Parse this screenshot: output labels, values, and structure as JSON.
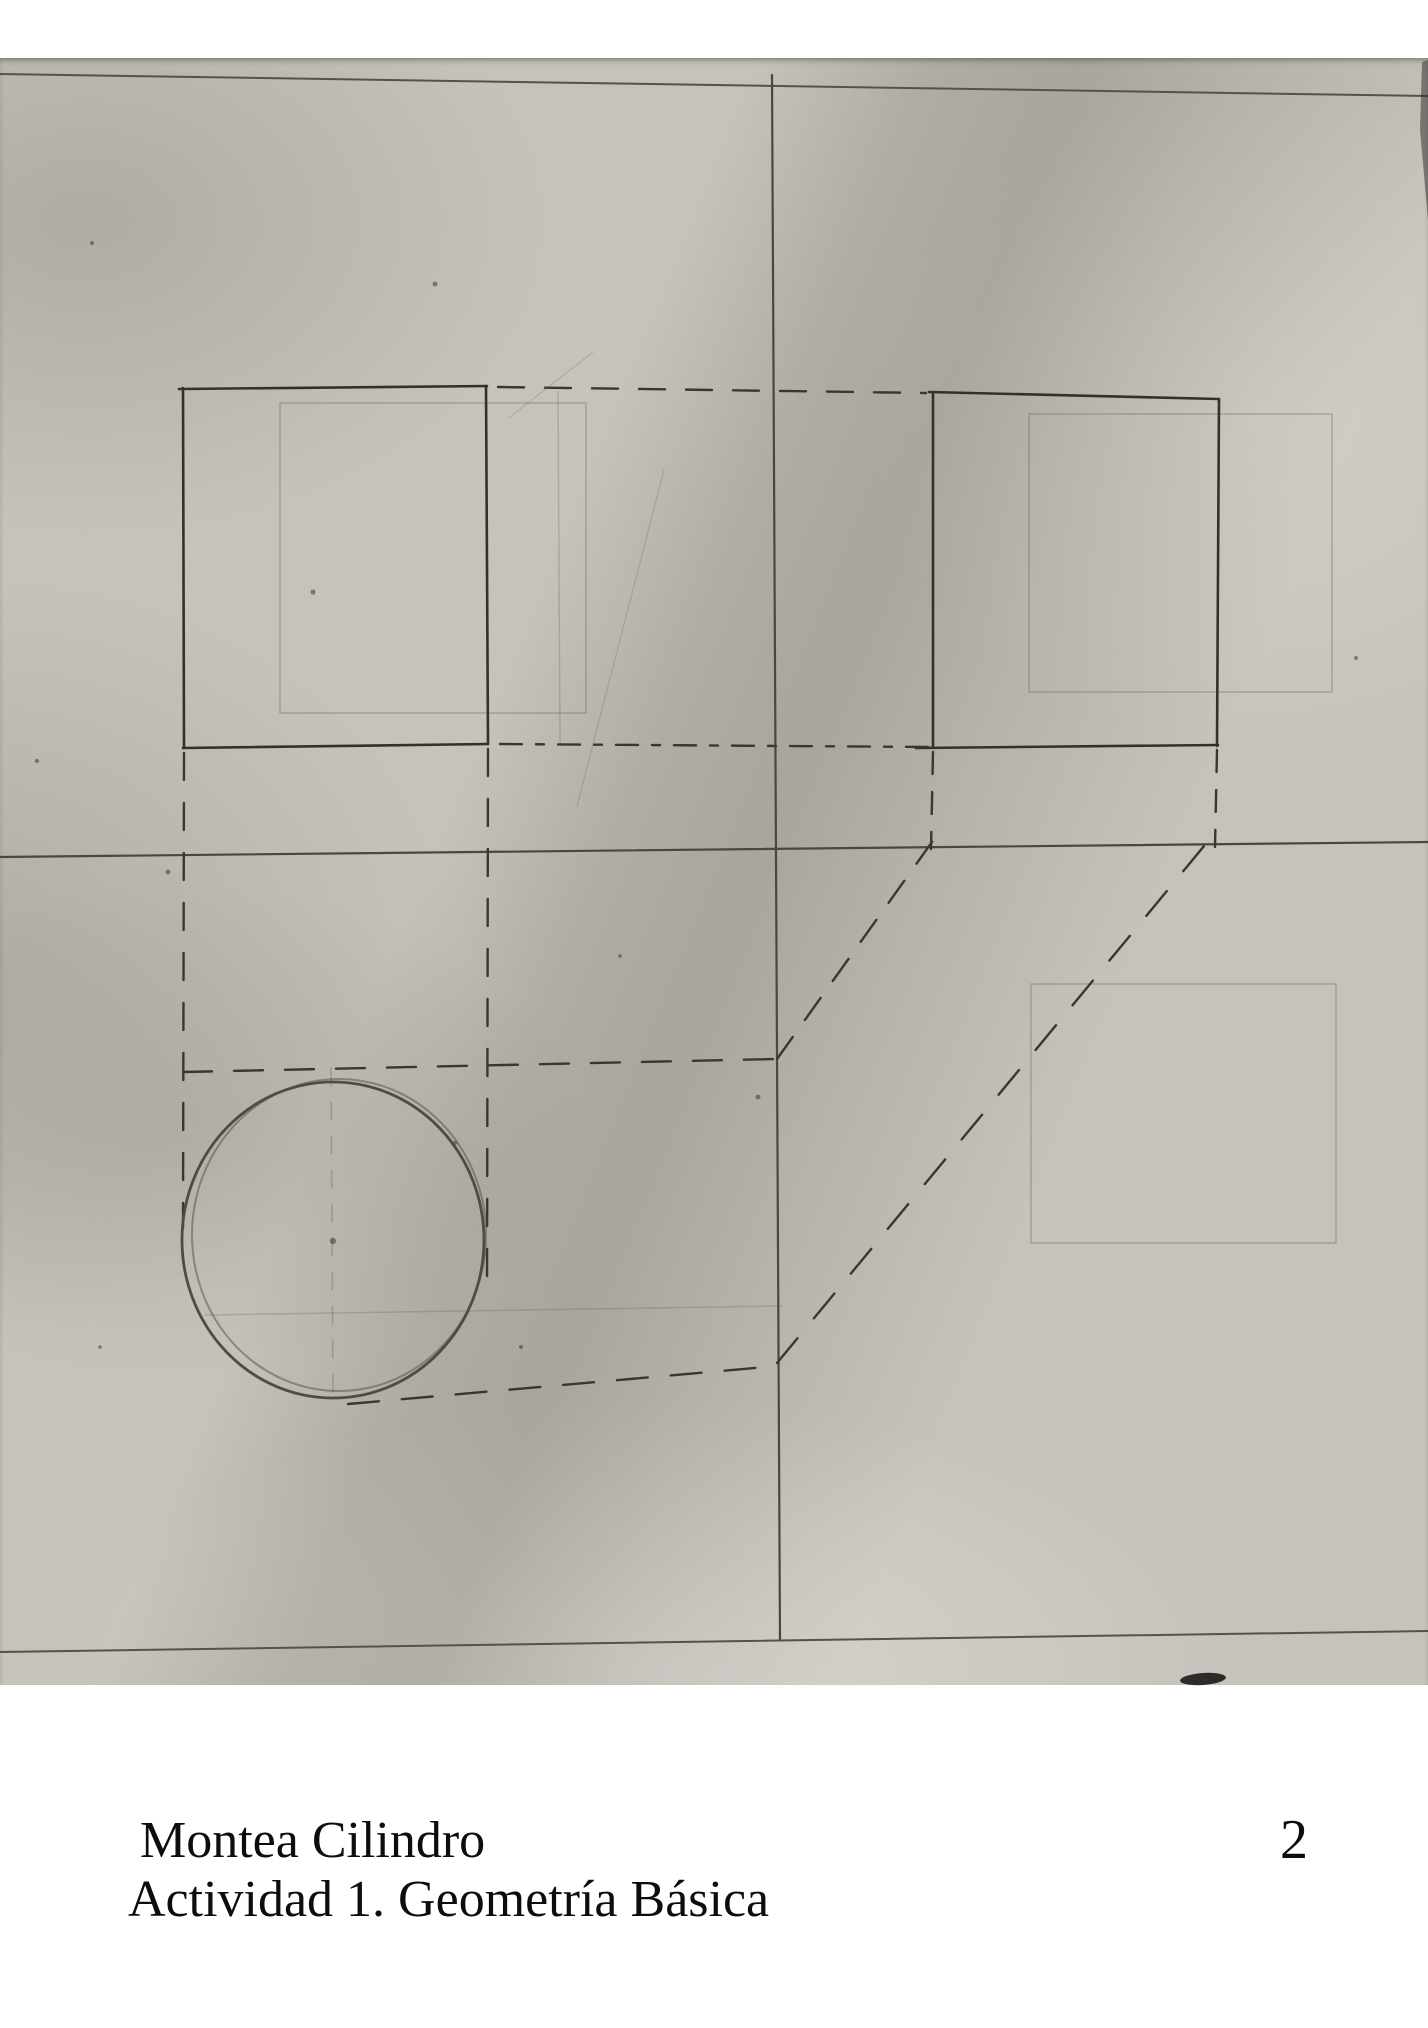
{
  "document": {
    "caption": {
      "line1": "Montea Cilindro",
      "line2": "Actividad 1. Geometría Básica"
    },
    "page_number": "2"
  },
  "drawing": {
    "colors": {
      "pencil": "#34312c",
      "frame": "#55524d",
      "dash": "#3a3732",
      "faint": "rgba(96,91,83,0.32)",
      "circle": "#4f4c46",
      "dot": "rgba(60,56,50,0.55)",
      "smudge": "#2e2c29"
    },
    "lines": [
      {
        "name": "sheet-top-border",
        "x1": 0,
        "y1": 74,
        "x2": 1428,
        "y2": 96,
        "w": 2,
        "color": "#55524d"
      },
      {
        "name": "sheet-bottom-border",
        "x1": 0,
        "y1": 1652,
        "x2": 1428,
        "y2": 1631,
        "w": 2,
        "color": "#55524d"
      },
      {
        "name": "vertical-divider",
        "x1": 772,
        "y1": 75,
        "x2": 780,
        "y2": 1640,
        "w": 2.2,
        "color": "#4a4741"
      },
      {
        "name": "horizontal-divider",
        "x1": 0,
        "y1": 857,
        "x2": 1428,
        "y2": 842,
        "w": 2.2,
        "color": "#4a4741"
      },
      {
        "name": "front-view-left-edge",
        "x1": 183,
        "y1": 388,
        "x2": 184,
        "y2": 748,
        "w": 2.6
      },
      {
        "name": "front-view-top-edge",
        "x1": 179,
        "y1": 389,
        "x2": 487,
        "y2": 386,
        "w": 2.6
      },
      {
        "name": "front-view-right-edge",
        "x1": 486,
        "y1": 386,
        "x2": 488,
        "y2": 744,
        "w": 2.6
      },
      {
        "name": "front-view-bottom-edge",
        "x1": 183,
        "y1": 748,
        "x2": 488,
        "y2": 744,
        "w": 2.6
      },
      {
        "name": "side-view-left-edge",
        "x1": 933,
        "y1": 394,
        "x2": 933,
        "y2": 747,
        "w": 2.6
      },
      {
        "name": "side-view-top-edge",
        "x1": 929,
        "y1": 392,
        "x2": 1219,
        "y2": 399,
        "w": 2.6
      },
      {
        "name": "side-view-right-edge",
        "x1": 1219,
        "y1": 399,
        "x2": 1217,
        "y2": 746,
        "w": 2.6
      },
      {
        "name": "side-view-bottom-edge",
        "x1": 916,
        "y1": 748,
        "x2": 1218,
        "y2": 745,
        "w": 2.6
      },
      {
        "name": "projection-top-connector",
        "x1": 498,
        "y1": 387,
        "x2": 926,
        "y2": 393,
        "w": 2.4,
        "color": "#3a3732",
        "dash": "26 21"
      },
      {
        "name": "projection-bottom-connector",
        "x1": 500,
        "y1": 744,
        "x2": 928,
        "y2": 747,
        "w": 2.4,
        "color": "#3a3732",
        "dash": "22 14 8 14"
      },
      {
        "name": "projection-below-front-left",
        "x1": 184,
        "y1": 753,
        "x2": 183,
        "y2": 1228,
        "w": 2.4,
        "color": "#3a3732",
        "dash": "27 23"
      },
      {
        "name": "projection-below-front-right",
        "x1": 488,
        "y1": 749,
        "x2": 487,
        "y2": 1292,
        "w": 2.4,
        "color": "#3a3732",
        "dash": "27 23"
      },
      {
        "name": "projection-below-side-left",
        "x1": 933,
        "y1": 752,
        "x2": 931,
        "y2": 849,
        "w": 2.4,
        "color": "#3a3732",
        "dash": "22 18"
      },
      {
        "name": "projection-below-side-right",
        "x1": 1217,
        "y1": 750,
        "x2": 1215,
        "y2": 847,
        "w": 2.4,
        "color": "#3a3732",
        "dash": "22 18"
      },
      {
        "name": "topview-front-edge",
        "x1": 183,
        "y1": 1072,
        "x2": 777,
        "y2": 1059,
        "w": 2.4,
        "color": "#3a3732",
        "dash": "29 22"
      },
      {
        "name": "topview-back-edge",
        "x1": 348,
        "y1": 1404,
        "x2": 777,
        "y2": 1366,
        "w": 2.4,
        "color": "#3a3732",
        "dash": "31 23"
      },
      {
        "name": "transfer-diagonal-short",
        "x1": 777,
        "y1": 1059,
        "x2": 937,
        "y2": 835,
        "w": 2.4,
        "color": "#3a3732",
        "dash": "27 21"
      },
      {
        "name": "transfer-diagonal-long",
        "x1": 777,
        "y1": 1363,
        "x2": 1209,
        "y2": 840,
        "w": 2.4,
        "color": "#3a3732",
        "dash": "32 26"
      },
      {
        "name": "circle-vertical-centerline",
        "x1": 331,
        "y1": 1068,
        "x2": 333,
        "y2": 1398,
        "w": 1.6,
        "color": "rgba(96,91,83,0.32)",
        "dash": "18 16"
      },
      {
        "name": "faint-horizontal-construction",
        "x1": 205,
        "y1": 1315,
        "x2": 782,
        "y2": 1306,
        "w": 1.5,
        "color": "rgba(96,91,83,0.26)"
      },
      {
        "name": "faint-front-inner-vertical",
        "x1": 558,
        "y1": 392,
        "x2": 560,
        "y2": 742,
        "w": 1.5,
        "color": "rgba(96,91,83,0.26)"
      },
      {
        "name": "paper-scratch-1",
        "x1": 664,
        "y1": 470,
        "x2": 577,
        "y2": 806,
        "w": 1.3,
        "color": "rgba(96,91,83,0.22)"
      },
      {
        "name": "paper-scratch-2",
        "x1": 510,
        "y1": 417,
        "x2": 593,
        "y2": 352,
        "w": 1.3,
        "color": "rgba(96,91,83,0.22)"
      }
    ],
    "rects": [
      {
        "name": "erased-front-construction-square",
        "x": 280,
        "y": 403,
        "w": 306,
        "h": 310
      },
      {
        "name": "erased-side-construction-square",
        "x": 1029,
        "y": 414,
        "w": 303,
        "h": 278
      },
      {
        "name": "erased-plan-construction-square",
        "x": 1031,
        "y": 984,
        "w": 305,
        "h": 259
      }
    ],
    "ellipses": [
      {
        "name": "topview-circle-outline",
        "cx": 333,
        "cy": 1240,
        "rx": 151,
        "ry": 158,
        "stroke": "#4f4c46",
        "w": 2.8
      },
      {
        "name": "topview-circle-second-stroke",
        "cx": 339,
        "cy": 1235,
        "rx": 147,
        "ry": 156,
        "stroke": "rgba(79,76,70,0.5)",
        "w": 2
      }
    ],
    "dots": [
      {
        "cx": 333,
        "cy": 1241,
        "r": 3.2
      },
      {
        "cx": 92,
        "cy": 243,
        "r": 2
      },
      {
        "cx": 435,
        "cy": 284,
        "r": 2.4
      },
      {
        "cx": 37,
        "cy": 761,
        "r": 2.2
      },
      {
        "cx": 168,
        "cy": 872,
        "r": 2.4
      },
      {
        "cx": 455,
        "cy": 1143,
        "r": 2
      },
      {
        "cx": 758,
        "cy": 1097,
        "r": 2.4
      },
      {
        "cx": 521,
        "cy": 1347,
        "r": 2
      },
      {
        "cx": 1356,
        "cy": 658,
        "r": 2
      },
      {
        "cx": 100,
        "cy": 1347,
        "r": 1.8
      },
      {
        "cx": 313,
        "cy": 592,
        "r": 2.6
      },
      {
        "cx": 620,
        "cy": 956,
        "r": 1.8
      }
    ],
    "smudge": {
      "name": "photo-bottom-smudge",
      "cx": 1203,
      "cy": 1679,
      "rx": 23,
      "ry": 6
    },
    "edge_wedge": {
      "name": "photo-edge-shadow",
      "points": "1428,60 1428,220 1420,130 1422,62"
    }
  }
}
